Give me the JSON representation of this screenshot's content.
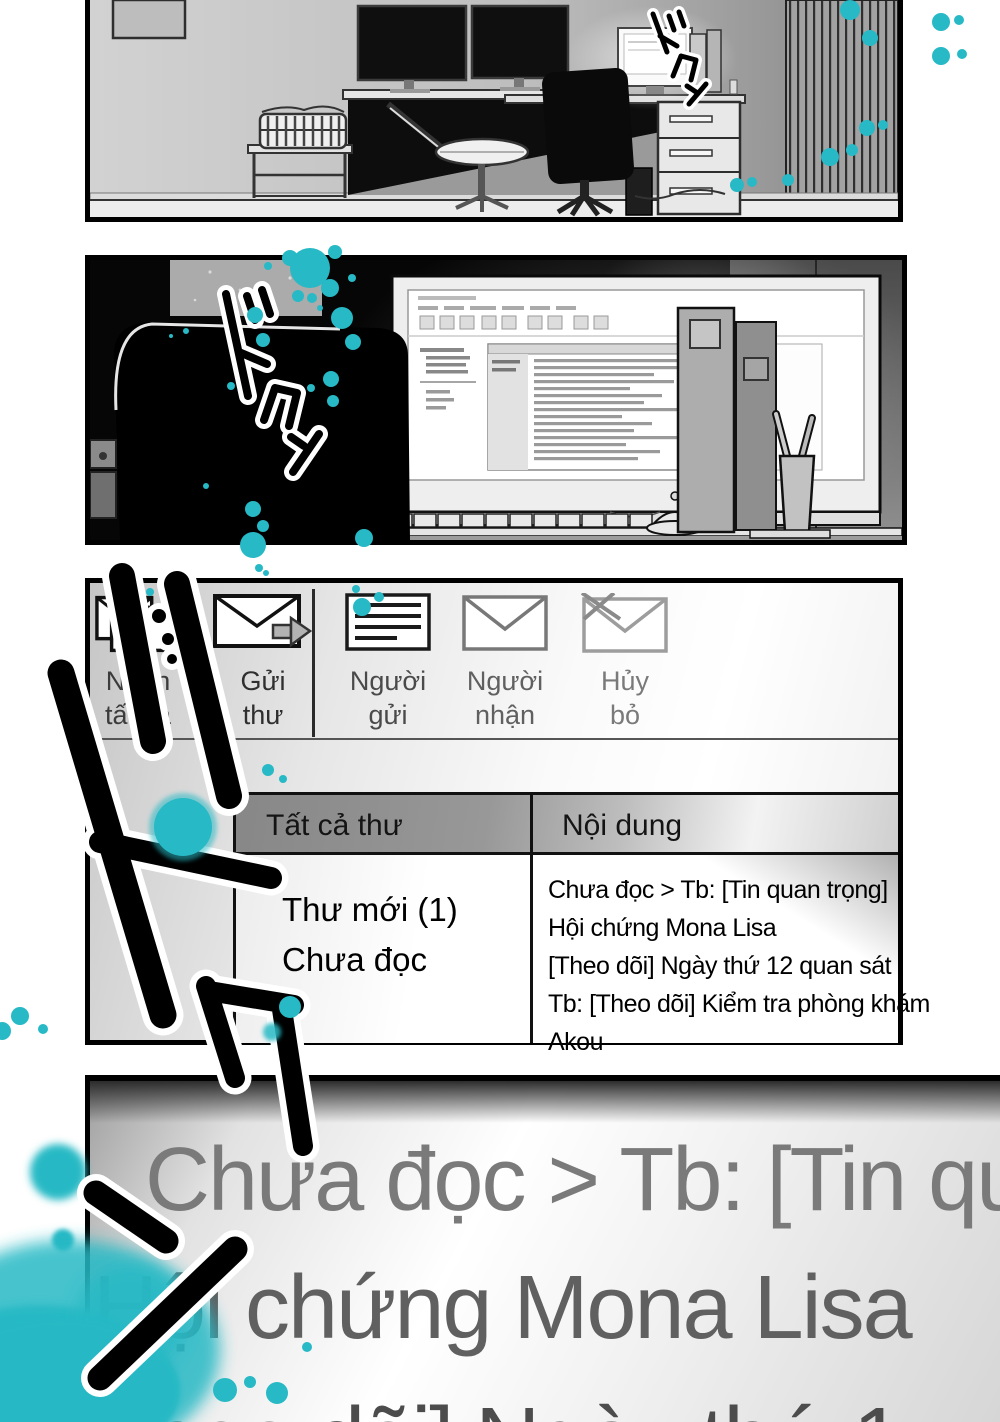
{
  "colors": {
    "teal": "#27b9c5",
    "ink": "#000000"
  },
  "sfx": {
    "dokun": "ドクン"
  },
  "panel3": {
    "toolbar": {
      "receive_all_line1": "Nhận",
      "receive_all_line2": "tất cả",
      "send_line1": "Gửi",
      "send_line2": "thư",
      "sender_line1": "Người",
      "sender_line2": "gửi",
      "recipient_line1": "Người",
      "recipient_line2": "nhận",
      "cancel_line1": "Hủy",
      "cancel_line2": "bỏ"
    },
    "table": {
      "col1_header": "Tất cả thư",
      "col2_header": "Nội dung",
      "folder_line1": "Thư mới (1)",
      "folder_line2": "Chưa đọc",
      "content_lines": [
        "Chưa đọc > Tb: [Tin quan trọng]",
        "Hội chứng Mona Lisa",
        "[Theo dõi] Ngày thứ 12 quan sát",
        "Tb: [Theo dõi] Kiểm tra phòng khám",
        "Akou"
      ]
    }
  },
  "panel4": {
    "line1": "Chưa đọc > Tb: [Tin qu",
    "line2": "Hội chứng Mona Lisa",
    "line3": "heo dõi] Ngày thứ 1"
  }
}
